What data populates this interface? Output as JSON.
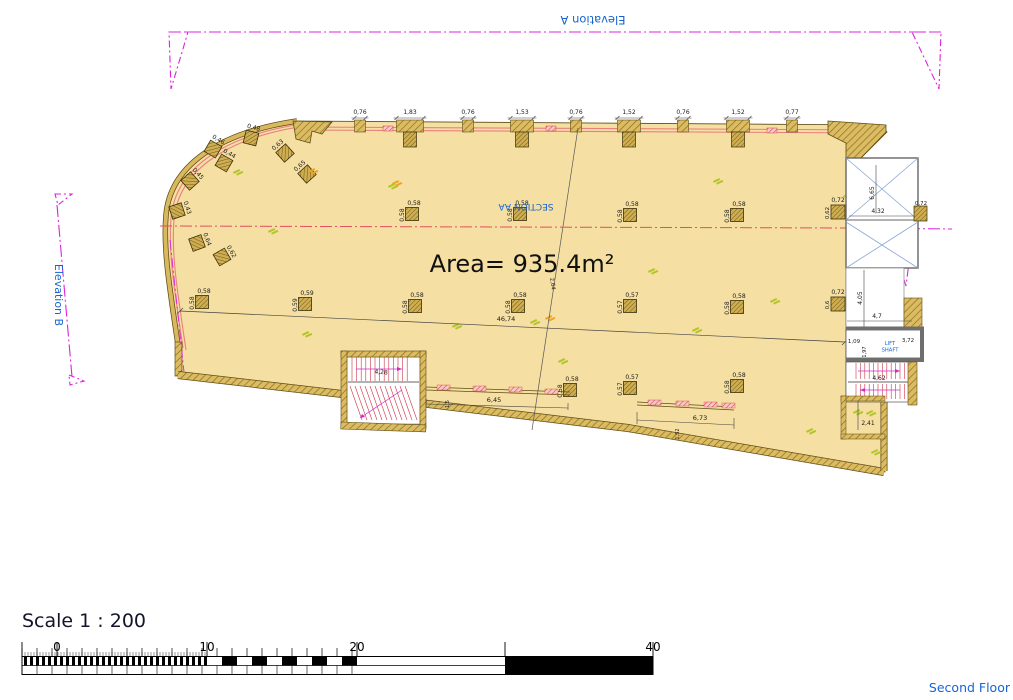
{
  "colors": {
    "tan": "#f5dfa2",
    "wall_hatch": "#dcbc62",
    "wall_line": "#8a6d20",
    "outline": "#5f4d15",
    "magenta": "#e020e0",
    "section_red": "#e05060",
    "salmon": "#e88080",
    "blue_text": "#1565d0",
    "shaft_x_blue": "#8aa7d6",
    "green_mark": "#b2c52a",
    "orange_mark": "#eda427",
    "red_detail": "#d94545"
  },
  "elevations": {
    "a_label": "Elevation A",
    "b_label": "Elevation B"
  },
  "plan": {
    "area_label": "Area= 935.4m²",
    "section_label": "SECTION AA",
    "overall_dim": "46,74",
    "diagonal_dim": "2,64",
    "top_dims": [
      {
        "v": "0,76",
        "x": 360,
        "w": 11
      },
      {
        "v": "1,83",
        "x": 410,
        "w": 27
      },
      {
        "v": "0,76",
        "x": 468,
        "w": 11
      },
      {
        "v": "1,53",
        "x": 522,
        "w": 23
      },
      {
        "v": "0,76",
        "x": 576,
        "w": 11
      },
      {
        "v": "1,52",
        "x": 629,
        "w": 23
      },
      {
        "v": "0,76",
        "x": 683,
        "w": 11
      },
      {
        "v": "1,52",
        "x": 738,
        "w": 23
      },
      {
        "v": "0,77",
        "x": 792,
        "w": 11
      }
    ],
    "field_cols": [
      {
        "v": "0,58",
        "x": 412,
        "y": 214
      },
      {
        "v": "0,58",
        "x": 520,
        "y": 214
      },
      {
        "v": "0,58",
        "x": 630,
        "y": 215
      },
      {
        "v": "0,58",
        "x": 737,
        "y": 215
      },
      {
        "v": "0,58",
        "x": 202,
        "y": 302
      },
      {
        "v": "0,59",
        "x": 305,
        "y": 304
      },
      {
        "v": "0,58",
        "x": 415,
        "y": 306
      },
      {
        "v": "0,58",
        "x": 518,
        "y": 306
      },
      {
        "v": "0,57",
        "x": 630,
        "y": 306
      },
      {
        "v": "0,58",
        "x": 737,
        "y": 307
      },
      {
        "v": "0,58",
        "x": 570,
        "y": 390
      },
      {
        "v": "0,57",
        "x": 630,
        "y": 388
      },
      {
        "v": "0,58",
        "x": 737,
        "y": 386
      }
    ],
    "curve_cols": [
      {
        "v": "0,48",
        "x": 251,
        "y": 138,
        "r": 14
      },
      {
        "v": "0,46",
        "x": 213,
        "y": 149,
        "r": 30
      },
      {
        "v": "0,44",
        "x": 224,
        "y": 163,
        "r": 30
      },
      {
        "v": "0,45",
        "x": 190,
        "y": 181,
        "r": 48
      },
      {
        "v": "0,43",
        "x": 177,
        "y": 211,
        "r": 72
      },
      {
        "v": "0,64",
        "x": 197,
        "y": 243,
        "r": 70
      },
      {
        "v": "0,62",
        "x": 222,
        "y": 257,
        "r": 60
      },
      {
        "v": "0,63",
        "x": 285,
        "y": 153,
        "r": -42
      },
      {
        "v": "0,65",
        "x": 307,
        "y": 174,
        "r": -42
      }
    ],
    "wall_cols": [
      {
        "label": "0,72",
        "side": "0,62",
        "x": 838,
        "y": 212
      },
      {
        "label": "0,72",
        "side": "0,6",
        "x": 838,
        "y": 304
      }
    ],
    "left_stair": {
      "dim": "4,28"
    },
    "railing1": {
      "dim": "6,45",
      "sub": "1,5"
    },
    "railing2": {
      "dim": "6,73",
      "sub": "1,52"
    },
    "shaft": {
      "width_dim": "4,32",
      "height_dim": "6,65",
      "right_dim": "0,72"
    },
    "corridor": {
      "height_dim": "4,05",
      "width_dim": "4,7"
    },
    "lift": {
      "label_line1": "LIFT",
      "label_line2": "SHAFT",
      "width_dim": "3,72",
      "left_dim": "1,09",
      "depth_dim": "1,97"
    },
    "right_stair": {
      "dim": "4,62"
    },
    "room": {
      "dim": "2,41"
    }
  },
  "scale_bar": {
    "title": "Scale 1 : 200",
    "tick_labels": [
      "0",
      "10",
      "20",
      "40"
    ],
    "floor_label": "Second Floor"
  }
}
